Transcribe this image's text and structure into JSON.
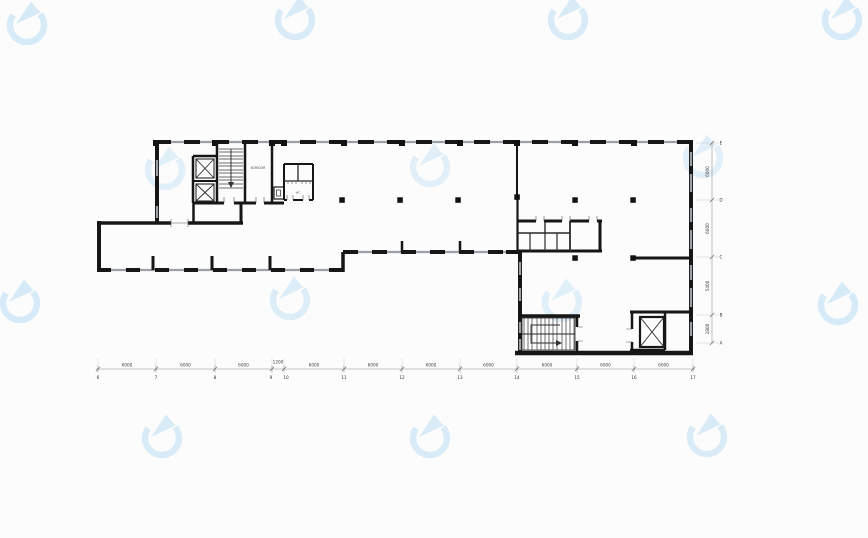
{
  "page": {
    "background": "#fcfcfd",
    "content_type": "architectural floor plan drawing"
  },
  "colors": {
    "wall": "#161616",
    "window": "#9aa0a6",
    "dimension_line": "#8a8a8a",
    "watermark_blue": "#b9dcf4"
  },
  "watermark": {
    "icon": "circular-arrow-logo",
    "count": 14
  },
  "plan": {
    "room_labels": {
      "corridor": "KORIDOR",
      "wc": "WC"
    },
    "grid_bottom": {
      "numbers": [
        "6",
        "7",
        "8",
        "9",
        "10",
        "11",
        "12",
        "13",
        "14",
        "15",
        "16",
        "17"
      ]
    },
    "grid_right": {
      "letters": [
        "E",
        "D",
        "C",
        "B",
        "A"
      ]
    },
    "dims_bottom": {
      "values": [
        "6000",
        "6000",
        "6000",
        "1200",
        "6000",
        "6000",
        "6000",
        "6000",
        "6000",
        "6000",
        "6000"
      ]
    },
    "dims_right": {
      "values": [
        "6000",
        "6000",
        "5400",
        "2800"
      ]
    }
  }
}
